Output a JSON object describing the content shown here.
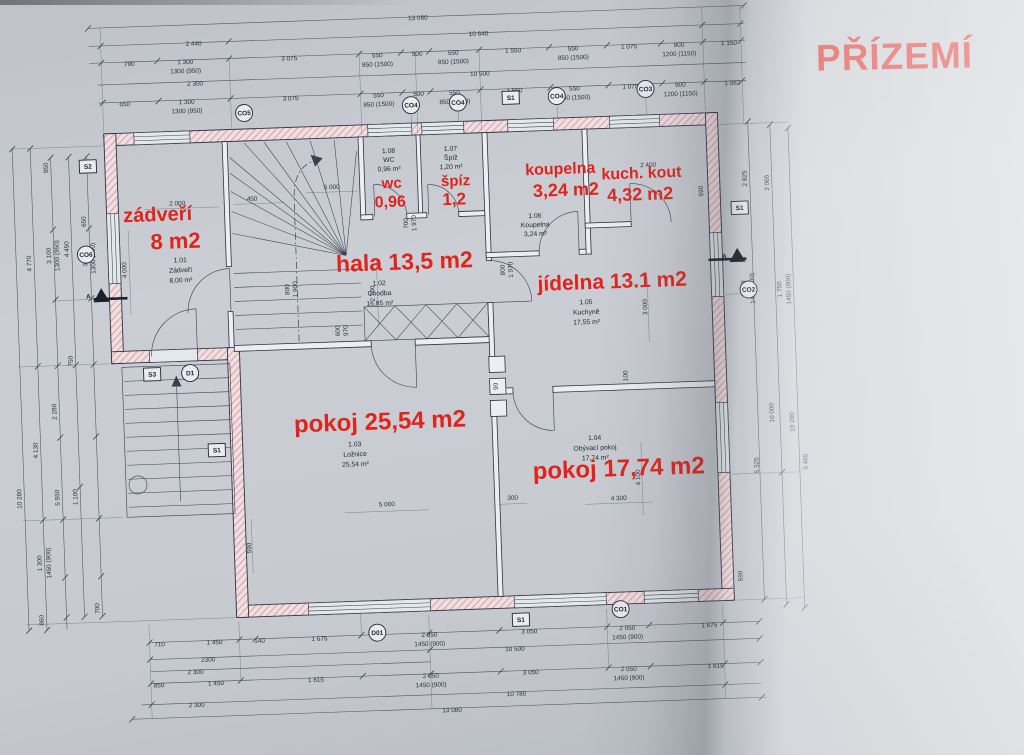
{
  "title": "PŘÍZEMÍ",
  "colors": {
    "annotation_red": "#e0241c",
    "line": "#2e3442",
    "wall_hatch": "#cf97a0",
    "paper": "#c7cad0"
  },
  "rooms": [
    {
      "num": "1.01",
      "name": "Zádveří",
      "area": "8,00 m²",
      "red": [
        "zádveří",
        "8 m2"
      ]
    },
    {
      "num": "1.02",
      "name": "Chodba",
      "area": "16,85 m²",
      "red": [
        "hala 13,5 m2"
      ]
    },
    {
      "num": "1.03",
      "name": "Ložnice",
      "area": "25,54 m²",
      "red": [
        "pokoj 25,54 m2"
      ]
    },
    {
      "num": "1.04",
      "name": "Obývací pokoj",
      "area": "17,74 m²",
      "red": [
        "pokoj 17,74 m2"
      ]
    },
    {
      "num": "1.05",
      "name": "Kuchyně",
      "area": "17,55 m²",
      "red": [
        "jídelna 13.1 m2"
      ]
    },
    {
      "num": "1.06",
      "name": "Koupelna",
      "area": "3,24 m²",
      "red": [
        "koupelna",
        "3,24 m2"
      ]
    },
    {
      "num": "1.07",
      "name": "Špíž",
      "area": "1,20 m²",
      "red": [
        "špíz",
        "1,2"
      ]
    },
    {
      "num": "1.08",
      "name": "WC",
      "area": "0,96 m²",
      "red": [
        "wc",
        "0,96"
      ]
    },
    {
      "num": "",
      "name": "",
      "area": "",
      "red": [
        "kuch. kout",
        "4,32 m2"
      ]
    }
  ],
  "markers": {
    "top": [
      "CO5",
      "CO4",
      "CO4",
      "S1",
      "CO4",
      "CO3"
    ],
    "left": [
      "S2",
      "CO6",
      "A",
      "S3",
      "D1",
      "S1"
    ],
    "right": [
      "S1",
      "A",
      "CO2"
    ],
    "bottom": [
      "D01",
      "S1",
      "CO1"
    ]
  },
  "dims": {
    "top": [
      "13 080",
      "2 440",
      "10 640",
      "790",
      "1 300",
      "1300 (950)",
      "3 075",
      "550",
      "850 (1500)",
      "500",
      "550",
      "850 (1500)",
      "1 550",
      "550",
      "850 (1500)",
      "1 075",
      "900",
      "1200 (1150)",
      "1 150",
      "2 300",
      "10 500",
      "650",
      "1 300",
      "1300 (950)",
      "3 075",
      "550",
      "850 (1500)",
      "500",
      "550",
      "850 (1500)",
      "1 550",
      "550",
      "850 (1500)",
      "1 075",
      "900",
      "1200 (1150)",
      "1 082"
    ],
    "bottom": [
      "710",
      "1 450",
      "140",
      "1 675",
      "2 050",
      "1450 (900)",
      "3 050",
      "2 050",
      "1450 (900)",
      "1 675",
      "2300",
      "10 500",
      "2 300",
      "850",
      "1 450",
      "1 815",
      "2 050",
      "1450 (900)",
      "3 050",
      "2 050",
      "1450 (900)",
      "1 815",
      "2 300",
      "10 780",
      "13 080"
    ],
    "left": [
      "10 280",
      "4 770",
      "4 130",
      "1 300",
      "1450 (900)",
      "860",
      "3 100",
      "1300 (950)",
      "4 450",
      "650",
      "950",
      "3 000",
      "1300 (950)",
      "750",
      "2 280",
      "5 550",
      "1 100",
      "700"
    ],
    "right": [
      "2 825",
      "3 065",
      "1 750",
      "1450 (900)",
      "1 750",
      "1450 (900)",
      "10 000",
      "10 280",
      "5 325",
      "5 465",
      "590"
    ],
    "inner": [
      "2 000",
      "450",
      "4 000",
      "5 000",
      "700",
      "1 970",
      "800",
      "1 900",
      "2 700",
      "600",
      "970",
      "800",
      "1 970",
      "2 400",
      "590",
      "3 000",
      "100",
      "4 100",
      "4 300",
      "5 000",
      "300",
      "590",
      "90"
    ]
  }
}
